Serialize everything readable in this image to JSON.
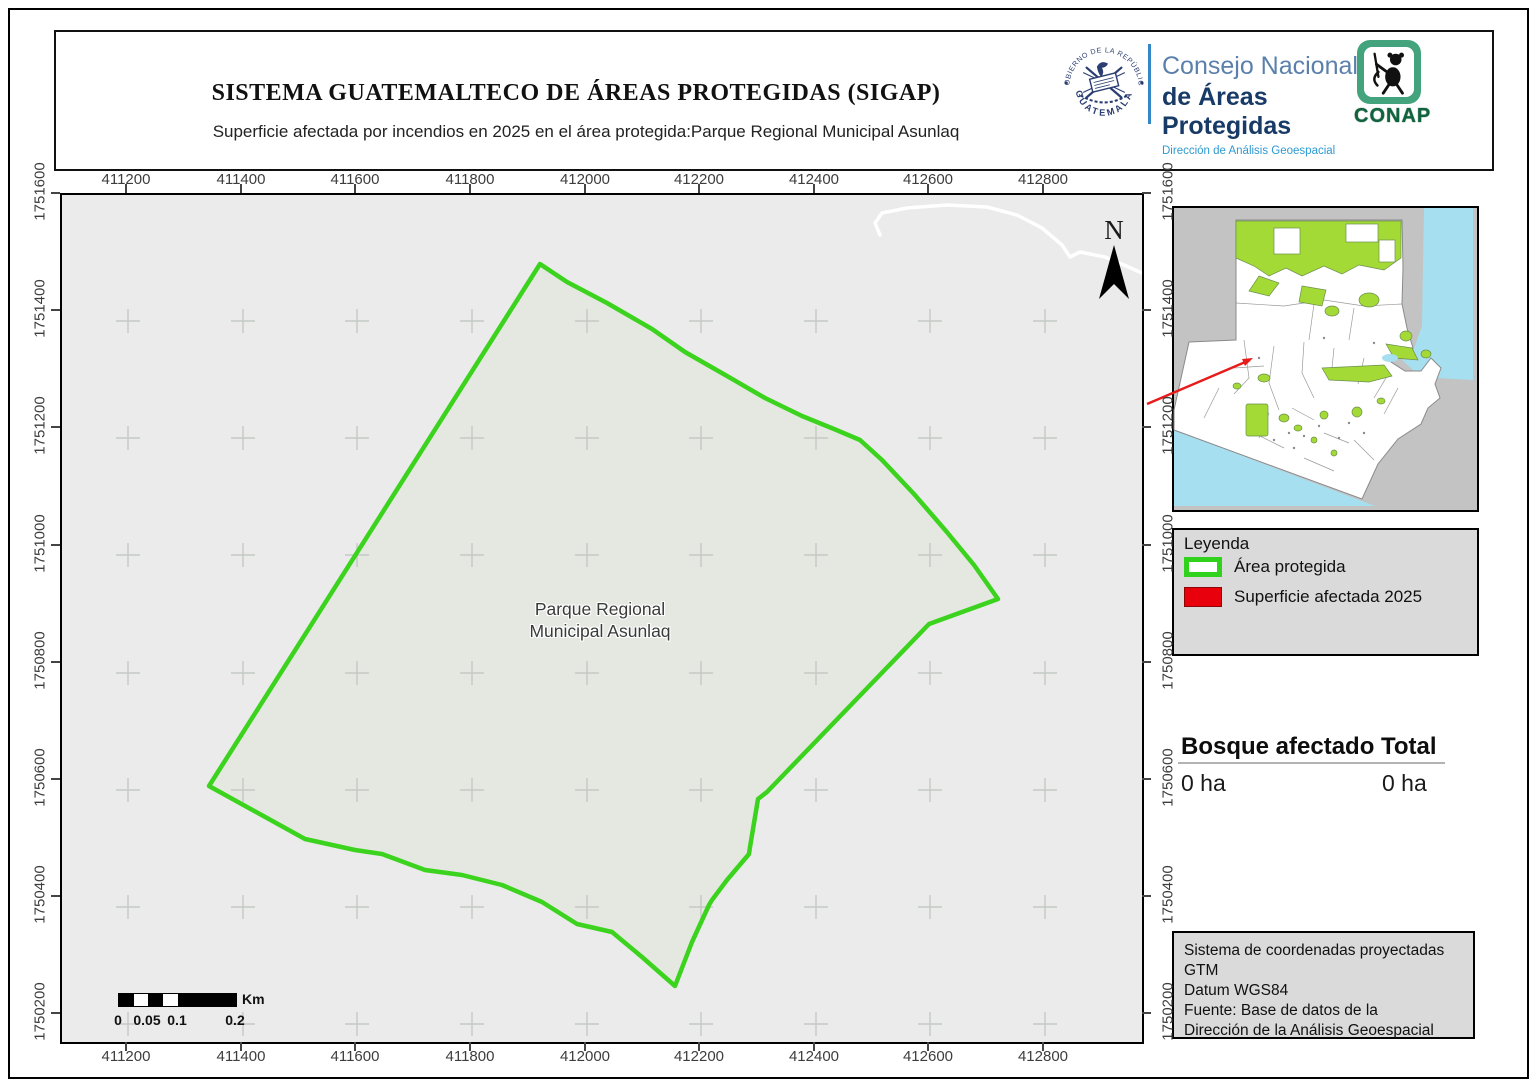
{
  "header": {
    "title": "SISTEMA GUATEMALTECO DE ÁREAS PROTEGIDAS  (SIGAP)",
    "subtitle": "Superficie afectada por incendios en 2025 en el área protegida:Parque Regional Municipal Asunlaq",
    "seal": {
      "top_text": "GOBIERNO DE LA REPÚBLICA",
      "bottom_text": "GUATEMALA"
    },
    "consejo": {
      "line1": "Consejo Nacional",
      "line2": "de Áreas Protegidas",
      "line3": "Dirección de Análisis Geoespacial"
    },
    "conap_word": "CONAP"
  },
  "map": {
    "x_ticks": [
      "411200",
      "411400",
      "411600",
      "411800",
      "412000",
      "412200",
      "412400",
      "412600",
      "412800"
    ],
    "y_ticks": [
      "1751600",
      "1751400",
      "1751200",
      "1751000",
      "1750800",
      "1750600",
      "1750400",
      "1750200"
    ],
    "area_label_line1": "Parque Regional",
    "area_label_line2": "Municipal Asunlaq",
    "north_label": "N",
    "scalebar": {
      "labels": [
        "0",
        "0.05",
        "0.1",
        "0.2"
      ],
      "unit": "Km"
    }
  },
  "legend": {
    "title": "Leyenda",
    "items": [
      {
        "label": "Área protegida",
        "type": "outline",
        "color": "#30d21c"
      },
      {
        "label": "Superficie afectada 2025",
        "type": "fill",
        "color": "#e8000c"
      }
    ]
  },
  "stats": {
    "col1_header": "Bosque afectado",
    "col2_header": "Total",
    "col1_value": "0 ha",
    "col2_value": "0 ha"
  },
  "info_box": {
    "lines": [
      "Sistema de coordenadas proyectadas",
      "GTM",
      "Datum WGS84",
      "Fuente: Base de datos de la",
      "Dirección de la Análisis Geoespacial"
    ]
  },
  "colors": {
    "protected_outline": "#30d21c",
    "affected_fill": "#e8000c",
    "polygon_interior": "#e5e8e1",
    "map_background": "#ebebeb",
    "overview_green": "#a3da35",
    "water_blue": "#a6dff0",
    "locator_arrow_red": "#e81a1a"
  }
}
